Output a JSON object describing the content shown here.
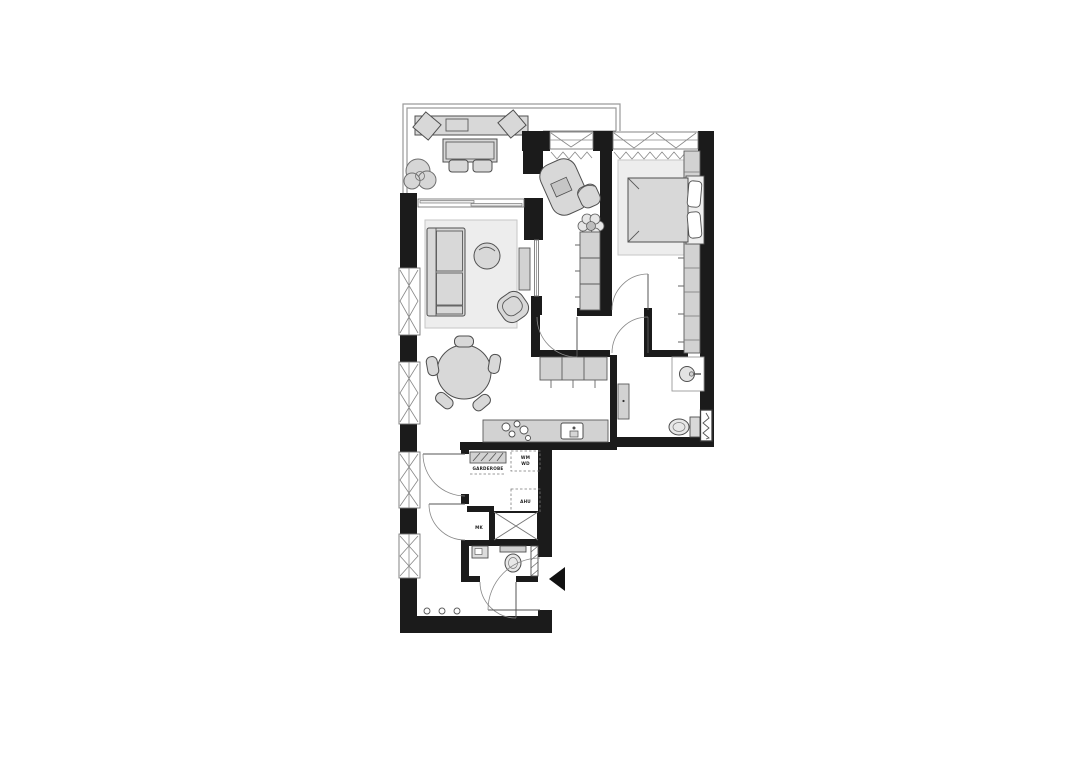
{
  "colors": {
    "wall": "#1b1b1b",
    "outline": "#4f4f4f",
    "furniture_fill": "#d8d8d8",
    "cabinet_fill": "#d2d2d2",
    "rug_fill": "#ededed",
    "background": "#ffffff"
  },
  "labels": {
    "wardrobe": "GARDEROBE",
    "washer": "WM",
    "dryer": "WD",
    "ahu": "AHU",
    "meter": "MK"
  }
}
